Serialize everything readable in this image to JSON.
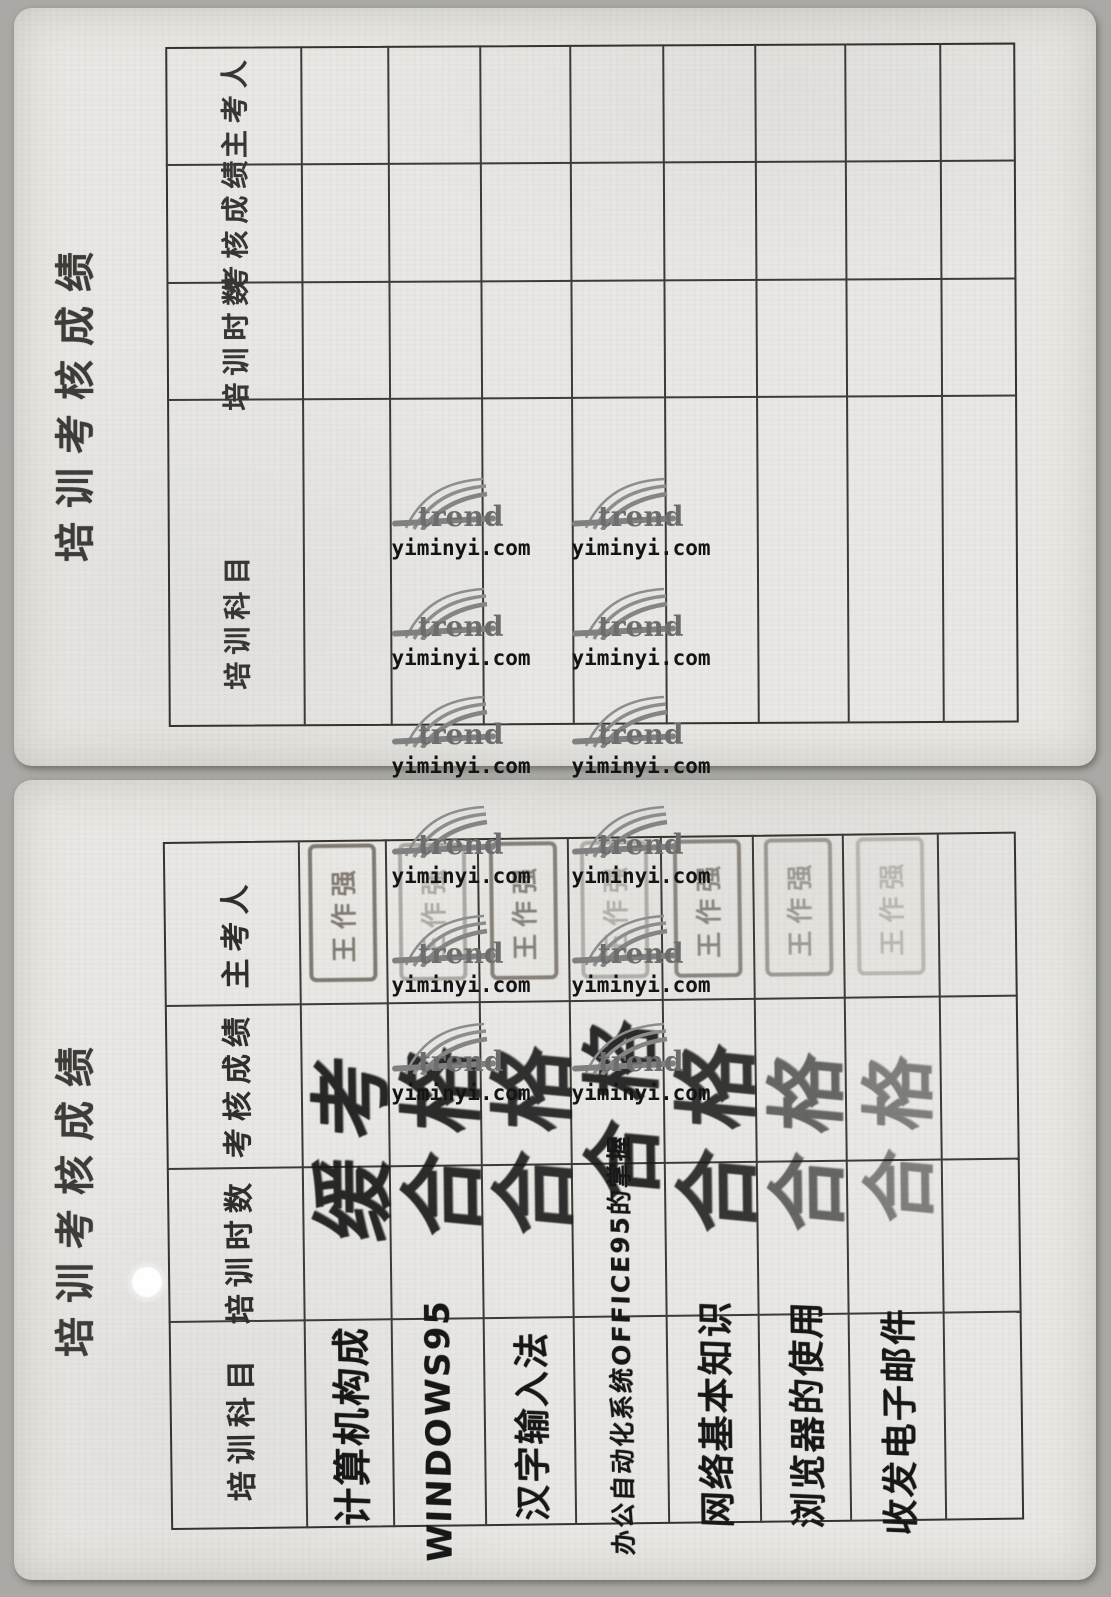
{
  "page": {
    "side_title": "培训考核成绩",
    "watermark": {
      "brand": "trend",
      "site": "yiminyi.com"
    }
  },
  "row_headers": [
    "主考人",
    "考核成绩",
    "培训时数",
    "培训科目"
  ],
  "colors": {
    "card_background": "#e9e8e4",
    "table_line": "#34332f",
    "handwriting_ink": "#171717",
    "stamp_ink": "#675f57",
    "watermark_gray": "#6d6d6d",
    "watermark_black": "#141414"
  },
  "top_table": {
    "columns": 8,
    "entries": [
      {
        "subject": "",
        "hours": "",
        "score": "",
        "examiner": ""
      },
      {
        "subject": "",
        "hours": "",
        "score": "",
        "examiner": ""
      },
      {
        "subject": "",
        "hours": "",
        "score": "",
        "examiner": ""
      },
      {
        "subject": "",
        "hours": "",
        "score": "",
        "examiner": ""
      },
      {
        "subject": "",
        "hours": "",
        "score": "",
        "examiner": ""
      },
      {
        "subject": "",
        "hours": "",
        "score": "",
        "examiner": ""
      },
      {
        "subject": "",
        "hours": "",
        "score": "",
        "examiner": ""
      },
      {
        "subject": "",
        "hours": "",
        "score": "",
        "examiner": ""
      }
    ]
  },
  "bottom_table": {
    "columns": 8,
    "entries": [
      {
        "subject": "计算机构成",
        "hours": "",
        "score": "缓考",
        "examiner": "王作强"
      },
      {
        "subject": "WINDOWS95",
        "hours": "",
        "score": "合格",
        "examiner": "王作强"
      },
      {
        "subject": "汉字输入法",
        "hours": "",
        "score": "合格",
        "examiner": "王作强"
      },
      {
        "subject": "办公自动化系统OFFICE95的掌握",
        "hours": "",
        "score": "合格",
        "examiner": "王作强"
      },
      {
        "subject": "网络基本知识",
        "hours": "",
        "score": "合格",
        "examiner": "王作强"
      },
      {
        "subject": "浏览器的使用",
        "hours": "",
        "score": "合格",
        "examiner": "王作强"
      },
      {
        "subject": "收发电子邮件",
        "hours": "",
        "score": "合格",
        "examiner": "王作强"
      },
      {
        "subject": "",
        "hours": "",
        "score": "",
        "examiner": ""
      }
    ]
  }
}
